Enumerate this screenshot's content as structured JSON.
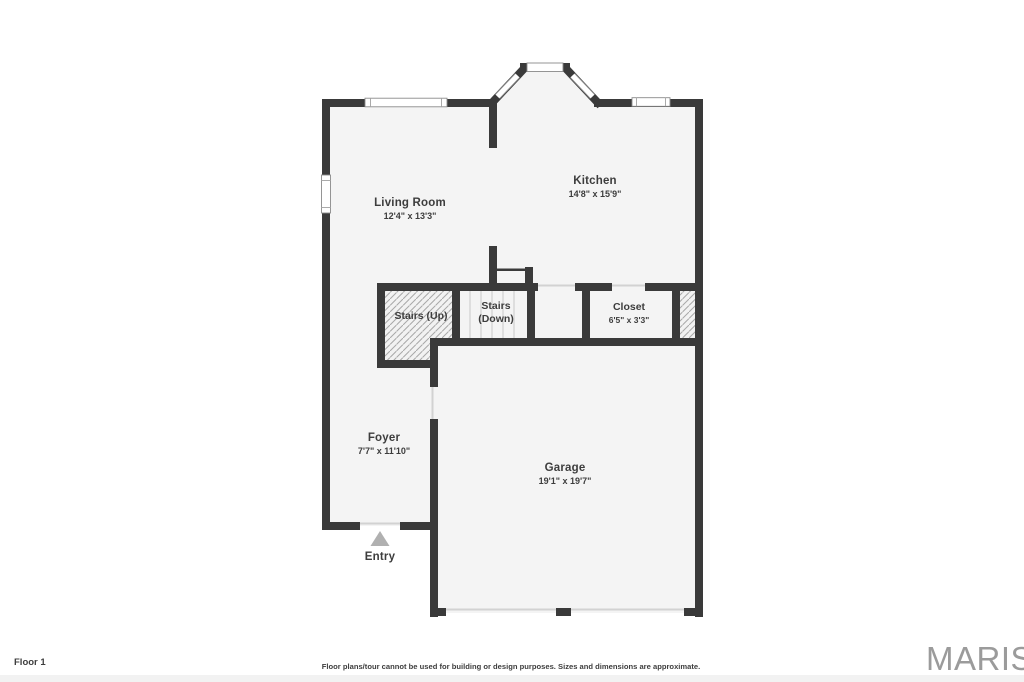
{
  "plan": {
    "wall_color": "#3a3a3a",
    "floor_color": "#f4f4f4",
    "hatch_line_color": "#a8a8a8",
    "window_border_color": "#8a8a8a",
    "entry_arrow_color": "#b0b0b0",
    "rooms": [
      {
        "id": "living-room",
        "name": "Living Room",
        "dims": "12'4\" x 13'3\""
      },
      {
        "id": "kitchen",
        "name": "Kitchen",
        "dims": "14'8\" x 15'9\""
      },
      {
        "id": "stairs-up",
        "name": "Stairs (Up)",
        "dims": ""
      },
      {
        "id": "stairs-down",
        "name": "Stairs\n(Down)",
        "dims": ""
      },
      {
        "id": "closet",
        "name": "Closet",
        "dims": "6'5\" x 3'3\""
      },
      {
        "id": "foyer",
        "name": "Foyer",
        "dims": "7'7\" x 11'10\""
      },
      {
        "id": "garage",
        "name": "Garage",
        "dims": "19'1\" x 19'7\""
      }
    ],
    "entry_label": "Entry"
  },
  "footer": {
    "floor_label": "Floor 1",
    "disclaimer": "Floor plans/tour cannot be used for building or design purposes. Sizes and dimensions are approximate.",
    "brand": "MARIS"
  }
}
